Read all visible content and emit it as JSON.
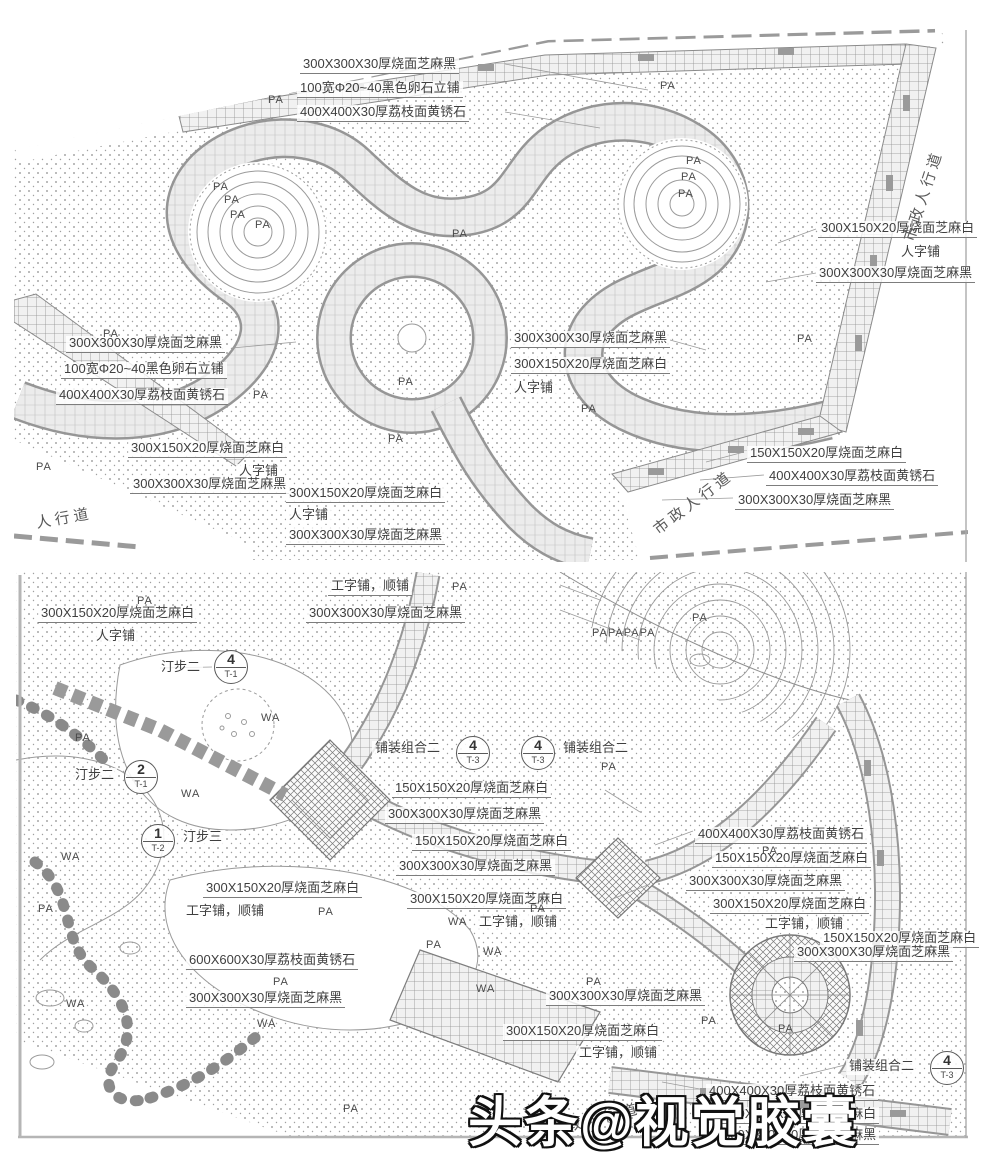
{
  "watermark": {
    "text": "头条@视觉胶囊"
  },
  "panel1": {
    "labels": [
      {
        "t": "300X300X30厚烧面芝麻黑",
        "x": 300,
        "y": 57
      },
      {
        "t": "100宽Φ20~40黑色卵石立铺",
        "x": 297,
        "y": 81
      },
      {
        "t": "400X400X30厚荔枝面黄锈石",
        "x": 297,
        "y": 105
      },
      {
        "t": "300X150X20厚烧面芝麻白",
        "x": 818,
        "y": 221
      },
      {
        "t": "人字铺",
        "x": 898,
        "y": 245,
        "ul": false
      },
      {
        "t": "300X300X30厚烧面芝麻黑",
        "x": 816,
        "y": 266
      },
      {
        "t": "300X300X30厚烧面芝麻黑",
        "x": 66,
        "y": 336
      },
      {
        "t": "100宽Φ20~40黑色卵石立铺",
        "x": 61,
        "y": 362
      },
      {
        "t": "400X400X30厚荔枝面黄锈石",
        "x": 56,
        "y": 388
      },
      {
        "t": "300X300X30厚烧面芝麻黑",
        "x": 511,
        "y": 331
      },
      {
        "t": "300X150X20厚烧面芝麻白",
        "x": 511,
        "y": 357
      },
      {
        "t": "人字铺",
        "x": 511,
        "y": 381,
        "ul": false
      },
      {
        "t": "300X150X20厚烧面芝麻白",
        "x": 128,
        "y": 441
      },
      {
        "t": "人字铺",
        "x": 236,
        "y": 464,
        "ul": false
      },
      {
        "t": "300X300X30厚烧面芝麻黑",
        "x": 130,
        "y": 477
      },
      {
        "t": "300X150X20厚烧面芝麻白",
        "x": 286,
        "y": 486
      },
      {
        "t": "人字铺",
        "x": 286,
        "y": 508,
        "ul": false
      },
      {
        "t": "300X300X30厚烧面芝麻黑",
        "x": 286,
        "y": 528
      },
      {
        "t": "150X150X20厚烧面芝麻白",
        "x": 747,
        "y": 446
      },
      {
        "t": "400X400X30厚荔枝面黄锈石",
        "x": 766,
        "y": 469
      },
      {
        "t": "300X300X30厚烧面芝麻黑",
        "x": 735,
        "y": 493
      }
    ],
    "areas": [
      {
        "t": "PA",
        "x": 268,
        "y": 94
      },
      {
        "t": "PA",
        "x": 660,
        "y": 80
      },
      {
        "t": "PA",
        "x": 686,
        "y": 155
      },
      {
        "t": "PA",
        "x": 681,
        "y": 171
      },
      {
        "t": "PA",
        "x": 678,
        "y": 188
      },
      {
        "t": "PA",
        "x": 213,
        "y": 181
      },
      {
        "t": "PA",
        "x": 224,
        "y": 194
      },
      {
        "t": "PA",
        "x": 230,
        "y": 209
      },
      {
        "t": "PA",
        "x": 255,
        "y": 219
      },
      {
        "t": "PA",
        "x": 452,
        "y": 228
      },
      {
        "t": "PA",
        "x": 103,
        "y": 328
      },
      {
        "t": "PA",
        "x": 253,
        "y": 389
      },
      {
        "t": "PA",
        "x": 398,
        "y": 376
      },
      {
        "t": "PA",
        "x": 388,
        "y": 433
      },
      {
        "t": "PA",
        "x": 581,
        "y": 403
      },
      {
        "t": "PA",
        "x": 797,
        "y": 333
      },
      {
        "t": "PA",
        "x": 36,
        "y": 461
      }
    ],
    "callouts": [],
    "roads": [
      {
        "t": "市政人行道",
        "x": 908,
        "y": 230,
        "rot": -72
      },
      {
        "t": "市政人行道",
        "x": 655,
        "y": 520,
        "rot": -37
      },
      {
        "t": "人行道",
        "x": 36,
        "y": 512,
        "rot": -10
      }
    ]
  },
  "panel2": {
    "labels": [
      {
        "t": "300X150X20厚烧面芝麻白",
        "x": 38,
        "y": 606
      },
      {
        "t": "人字铺",
        "x": 93,
        "y": 629,
        "ul": false
      },
      {
        "t": "工字铺，顺铺",
        "x": 328,
        "y": 579
      },
      {
        "t": "300X300X30厚烧面芝麻黑",
        "x": 306,
        "y": 606
      },
      {
        "t": "汀步二",
        "x": 158,
        "y": 660,
        "ul": false
      },
      {
        "t": "汀步二",
        "x": 72,
        "y": 768,
        "ul": false
      },
      {
        "t": "汀步三",
        "x": 180,
        "y": 830,
        "ul": false
      },
      {
        "t": "铺装组合二",
        "x": 372,
        "y": 741,
        "ul": false
      },
      {
        "t": "铺装组合二",
        "x": 560,
        "y": 741,
        "ul": false
      },
      {
        "t": "150X150X20厚烧面芝麻白",
        "x": 392,
        "y": 781
      },
      {
        "t": "300X300X30厚烧面芝麻黑",
        "x": 385,
        "y": 807
      },
      {
        "t": "150X150X20厚烧面芝麻白",
        "x": 412,
        "y": 834
      },
      {
        "t": "300X300X30厚烧面芝麻黑",
        "x": 396,
        "y": 859
      },
      {
        "t": "300X150X20厚烧面芝麻白",
        "x": 407,
        "y": 892
      },
      {
        "t": "工字铺，顺铺",
        "x": 476,
        "y": 915,
        "ul": false
      },
      {
        "t": "400X400X30厚荔枝面黄锈石",
        "x": 695,
        "y": 827
      },
      {
        "t": "150X150X20厚烧面芝麻白",
        "x": 712,
        "y": 851
      },
      {
        "t": "300X300X30厚烧面芝麻黑",
        "x": 686,
        "y": 874
      },
      {
        "t": "300X150X20厚烧面芝麻白",
        "x": 710,
        "y": 897
      },
      {
        "t": "工字铺，顺铺",
        "x": 762,
        "y": 917,
        "ul": false
      },
      {
        "t": "150X150X20厚烧面芝麻白",
        "x": 820,
        "y": 931
      },
      {
        "t": "300X300X30厚烧面芝麻黑",
        "x": 794,
        "y": 945
      },
      {
        "t": "300X150X20厚烧面芝麻白",
        "x": 203,
        "y": 881
      },
      {
        "t": "工字铺，顺铺",
        "x": 183,
        "y": 904,
        "ul": false
      },
      {
        "t": "600X600X30厚荔枝面黄锈石",
        "x": 186,
        "y": 953
      },
      {
        "t": "300X300X30厚烧面芝麻黑",
        "x": 186,
        "y": 991
      },
      {
        "t": "300X300X30厚烧面芝麻黑",
        "x": 546,
        "y": 989
      },
      {
        "t": "300X150X20厚烧面芝麻白",
        "x": 503,
        "y": 1024
      },
      {
        "t": "工字铺，顺铺",
        "x": 576,
        "y": 1046,
        "ul": false
      },
      {
        "t": "铺装组合二",
        "x": 846,
        "y": 1059,
        "ul": false
      },
      {
        "t": "400X400X30厚荔枝面黄锈石",
        "x": 706,
        "y": 1084
      },
      {
        "t": "150X150X20厚烧面芝麻白",
        "x": 720,
        "y": 1107
      },
      {
        "t": "300X300X30厚烧面芝麻黑",
        "x": 720,
        "y": 1128
      }
    ],
    "areas": [
      {
        "t": "PA",
        "x": 137,
        "y": 595
      },
      {
        "t": "PA",
        "x": 452,
        "y": 581
      },
      {
        "t": "PA",
        "x": 692,
        "y": 612
      },
      {
        "t": "PAPAPAPA",
        "x": 592,
        "y": 627
      },
      {
        "t": "PA",
        "x": 75,
        "y": 732
      },
      {
        "t": "WA",
        "x": 261,
        "y": 712
      },
      {
        "t": "WA",
        "x": 181,
        "y": 788
      },
      {
        "t": "WA",
        "x": 61,
        "y": 851
      },
      {
        "t": "PA",
        "x": 38,
        "y": 903
      },
      {
        "t": "PA",
        "x": 318,
        "y": 906
      },
      {
        "t": "PA",
        "x": 601,
        "y": 761
      },
      {
        "t": "PA",
        "x": 762,
        "y": 845
      },
      {
        "t": "PA",
        "x": 530,
        "y": 903
      },
      {
        "t": "PA",
        "x": 273,
        "y": 976
      },
      {
        "t": "PA",
        "x": 426,
        "y": 939
      },
      {
        "t": "WA",
        "x": 448,
        "y": 916
      },
      {
        "t": "WA",
        "x": 483,
        "y": 946
      },
      {
        "t": "WA",
        "x": 476,
        "y": 983
      },
      {
        "t": "PA",
        "x": 586,
        "y": 976
      },
      {
        "t": "PA",
        "x": 701,
        "y": 1015
      },
      {
        "t": "PA",
        "x": 778,
        "y": 1023
      },
      {
        "t": "WA",
        "x": 66,
        "y": 998
      },
      {
        "t": "WA",
        "x": 257,
        "y": 1018
      },
      {
        "t": "PA",
        "x": 343,
        "y": 1103
      }
    ],
    "callouts": [
      {
        "num": "4",
        "ref": "T-1",
        "x": 214,
        "y": 650
      },
      {
        "num": "2",
        "ref": "T-1",
        "x": 124,
        "y": 760
      },
      {
        "num": "1",
        "ref": "T-2",
        "x": 141,
        "y": 824
      },
      {
        "num": "4",
        "ref": "T-3",
        "x": 456,
        "y": 736
      },
      {
        "num": "4",
        "ref": "T-3",
        "x": 521,
        "y": 736
      },
      {
        "num": "4",
        "ref": "T-3",
        "x": 930,
        "y": 1051
      }
    ],
    "roads": [
      {
        "t": "市政人行道",
        "x": 548,
        "y": 1120,
        "rot": -14
      }
    ]
  }
}
